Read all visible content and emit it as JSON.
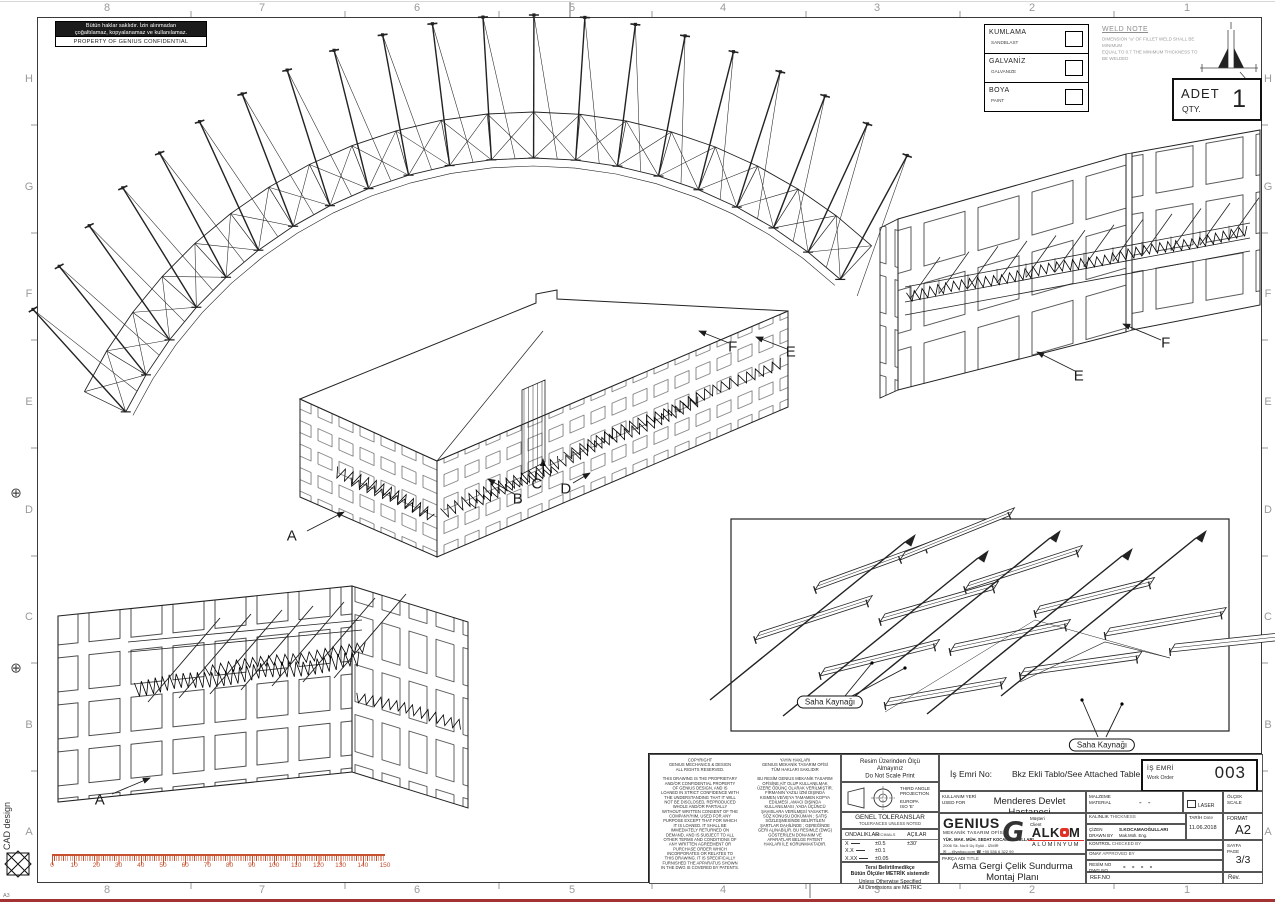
{
  "sheet": {
    "accent_red": "#c8502e",
    "alkom_red": "#e03127",
    "line_color": "#222222"
  },
  "margin": {
    "cols": [
      "8",
      "7",
      "6",
      "5",
      "4",
      "3",
      "2",
      "1"
    ],
    "rows": [
      "H",
      "G",
      "F",
      "E",
      "D",
      "C",
      "B",
      "A"
    ]
  },
  "side_notes": {
    "cad": "CAD design",
    "corner": "A3"
  },
  "confidential": {
    "tr1": "Bütün haklar saklıdır. İzin alınmadan",
    "tr2": "çoğaltılamaz, kopyalanamaz ve kullanılamaz.",
    "en": "PROPERTY OF GENIUS CONFIDENTIAL"
  },
  "finish_legend": {
    "rows": [
      {
        "tr": "KUMLAMA",
        "en": "SANDBLAST"
      },
      {
        "tr": "GALVANİZ",
        "en": "GALVANIZE"
      },
      {
        "tr": "BOYA",
        "en": "PAINT"
      }
    ]
  },
  "weld_note": {
    "title": "WELD NOTE",
    "body": "DIMENSION \"a\" OF FILLET WELD SHALL BE MINIMUM\nEQUAL TO 0.7 THE MINIMUM THICKNESS TO BE WELDED"
  },
  "qty": {
    "tr": "ADET",
    "en": "QTY.",
    "value": "1"
  },
  "view_labels": {
    "main_a": "A",
    "main_b": "B",
    "main_c": "C",
    "main_d": "D",
    "main_e": "E",
    "main_f": "F",
    "tr_e": "E",
    "tr_f": "F",
    "bl_a": "A",
    "weld_tag_1": "Saha Kaynağı",
    "weld_tag_2": "Saha Kaynağı"
  },
  "ruler": {
    "labels": [
      "0",
      "10",
      "20",
      "30",
      "40",
      "50",
      "60",
      "70",
      "80",
      "90",
      "100",
      "110",
      "120",
      "130",
      "140",
      "150"
    ]
  },
  "copyright": {
    "en": "COPYRIGHT\nGENIUS MECHANICS & DESIGN\nALL RIGHTS RESERVED.\n\nTHIS DRAWING IS THE PROPRIETARY\nAND/OR CONFIDENTIAL PROPERTY\nOF GENIUS DESIGN, AND IS\nLOANED IN STRICT CONFIDENCE WITH\nTHE UNDERSTANDING THAT IT WILL\nNOT BE DISCLOSED, REPRODUCED\nWHOLE AND/OR PARTIALLY\nWITHOUT WRITTEN CONSENT OF THE\nCOMPANY/HIM, USED FOR ANY\nPURPOSE EXCEPT THAT FOR WHICH\nIT IS LOANED. IT SHALL BE\nIMMEDIATELY RETURNED ON\nDEMAND, AND IS SUBJECT TO ALL\nOTHER TERMS AND CONDITIONS OF\nANY WRITTEN AGREEMENT OR\nPURCHASE ORDER WHICH\nINCORPORATES OR RELATES TO\nTHIS DRAWING. IT IS SPECIFICALLY\nFURNISHED THE APPARATUS SHOWN\nIN THE DWG IS COVERED BY PATENTS.",
    "tr": "YAYIN HAKLARI\nGENIUS MEKANİK TASARIM OFİSİ\nTÜM HAKLARI SAKLIDIR\n\nBU RESİM GENIUS MEKANİK TASARIM\nOFİSİNE AİT OLUP KULLANILMAK\nÜZERE ÖDÜNÇ OLARAK VERİLMİŞTİR.\nFİRMANIN YAZILI İZNİ DIŞINDA\nKISMEN VE/VEYA TAMAMEN KOPYA\nEDİLMESİ ,AMACI DIŞINDA\nKULLANILMASI ,YADA ÜÇÜNCÜ\nŞAHISLARA VERİLMESİ YASAKTIR.\nSÖZ KONUSU DOKÜMAN ; SATIŞ\nSÖZLEŞMESİNDE BELİRTİLEN\nŞARTLAR DAHİLİNDE ; GEREĞİNDE\nGERİ ALINABİLİR. BU RESİMLE (DWG)\nGÖSTERİLEN DONANIM VE\nAPARATLAR  BELGE PATENT\nHAKLARI İLE KORUNMAKTADIR."
  },
  "scale_note": "Resim Üzerinden Ölçü Almayınız\nDo Not Scale Print",
  "projection": {
    "l1": "THIRD ANGLE",
    "l2": "PROJECTION",
    "l3": "EUROPA",
    "l4": "ISO 'E'"
  },
  "tolerances": {
    "title_tr": "GENEL TOLERANSLAR",
    "title_en": "TOLERANCES UNLESS NOTED",
    "c1tr": "ONDALIKLAR",
    "c1en": "DECIMALS",
    "c2tr": "AÇILAR",
    "c2en": "ANGLES",
    "r1": [
      "X",
      "±0.5",
      "±30'"
    ],
    "r2": [
      "X.X",
      "±0.1",
      ""
    ],
    "r3": [
      "X.XX",
      "±0.05",
      ""
    ],
    "r4": [
      "X.XXX",
      "±0.005",
      ""
    ],
    "foot_tr": "Tersi Belirtilmedikçe\nBütün Ölçüler METRİK sistemdir",
    "foot_en": "Unless Otherwise Specified\nAll Dimensions are METRIC"
  },
  "title_block": {
    "is_emri_label": "İş Emri No:",
    "is_emri_value": "Bkz Ekli Tablo/See Attached Table",
    "work_order": {
      "tr": "İŞ EMRİ",
      "en": "Work Order",
      "value": "003"
    },
    "used_for": {
      "tr": "KULLANIM YERİ",
      "en": "USED FOR",
      "value": "Menderes Devlet Hastanesi"
    },
    "genius": {
      "name": "GENIUS",
      "office": "MEKANİK TASARIM OFİSİ",
      "engineer": "YÜK. MAK. MÜH. SEDAT KOCAMAOĞULLARI",
      "address": "2006 Sk. No:5 Üç Eylül - İZMİR",
      "contact": "✉ …@yahoo.com   ☎ +90 536 6 322 99",
      "glyph": "G"
    },
    "client": {
      "tr": "Müşteri",
      "en": "Client",
      "name_a": "ALK",
      "name_b": "M",
      "sub": "ALÜMİNYUM"
    },
    "part": {
      "tr": "PARÇA ADI",
      "en": "TITLE",
      "value": "Asma Gergi Çelik Sundurma\nMontaj Planı"
    },
    "material": {
      "tr": "MALZEME",
      "en": "MATERIAL",
      "value": "- -"
    },
    "thickness": {
      "tr": "KALINLIK",
      "en": "THICKNESS"
    },
    "drawn": {
      "tr": "ÇİZEN",
      "en": "DRAWN BY",
      "name": "S.KOCAMAOĞULLARI",
      "title": "Mak.Müh. Eng."
    },
    "checked": {
      "tr": "KONTROL",
      "en": "CHECKED BY"
    },
    "approved": {
      "tr": "ONAY",
      "en": "APPROVED BY"
    },
    "date": {
      "tr": "TARİH",
      "en": "Date",
      "value": "11.06.2018"
    },
    "laser": "LASER",
    "scale": {
      "tr": "ÖLÇEK",
      "en": "SCALE"
    },
    "format": {
      "label": "FORMAT",
      "value": "A2"
    },
    "page": {
      "tr": "SAYFA",
      "en": "PAGE",
      "value": "3/3"
    },
    "dwg": {
      "tr": "RESİM NO",
      "en": "DWG.NO",
      "value": "- -  - -"
    },
    "ref": "REF.NO",
    "rev": "Rev."
  }
}
